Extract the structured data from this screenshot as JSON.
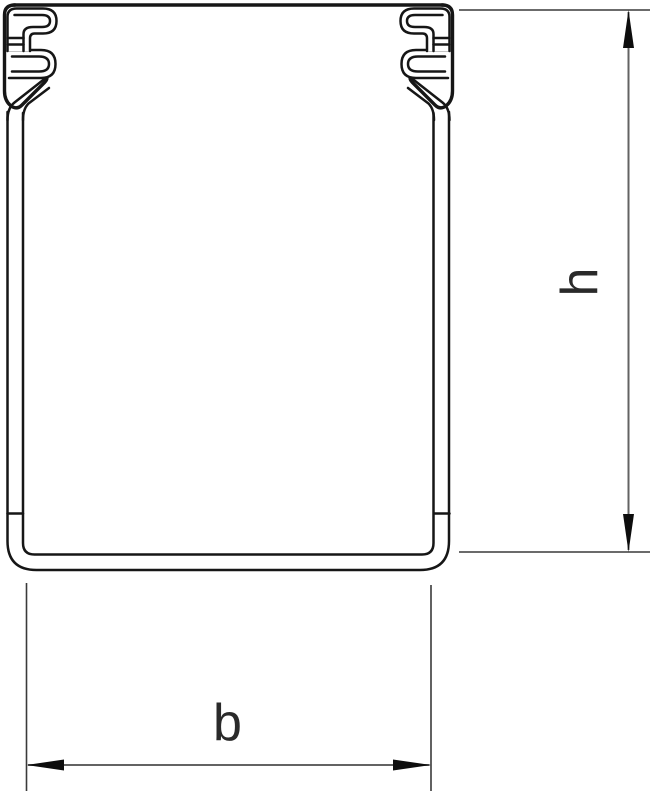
{
  "figure": {
    "kind": "technical-drawing",
    "subject": "cable-trunking-cross-section-with-cover",
    "canvas": {
      "width": 657,
      "height": 794,
      "background": "#ffffff"
    },
    "colors": {
      "profile_line": "#161616",
      "extension_line": "#3a3a3a",
      "dimension_line": "#636363",
      "arrowhead": "#0d0d0d",
      "label_text": "#2a2a2a"
    },
    "dimensions": {
      "height": {
        "label": "h",
        "orientation": "vertical",
        "side": "right"
      },
      "width": {
        "label": "b",
        "orientation": "horizontal",
        "side": "bottom"
      }
    }
  }
}
